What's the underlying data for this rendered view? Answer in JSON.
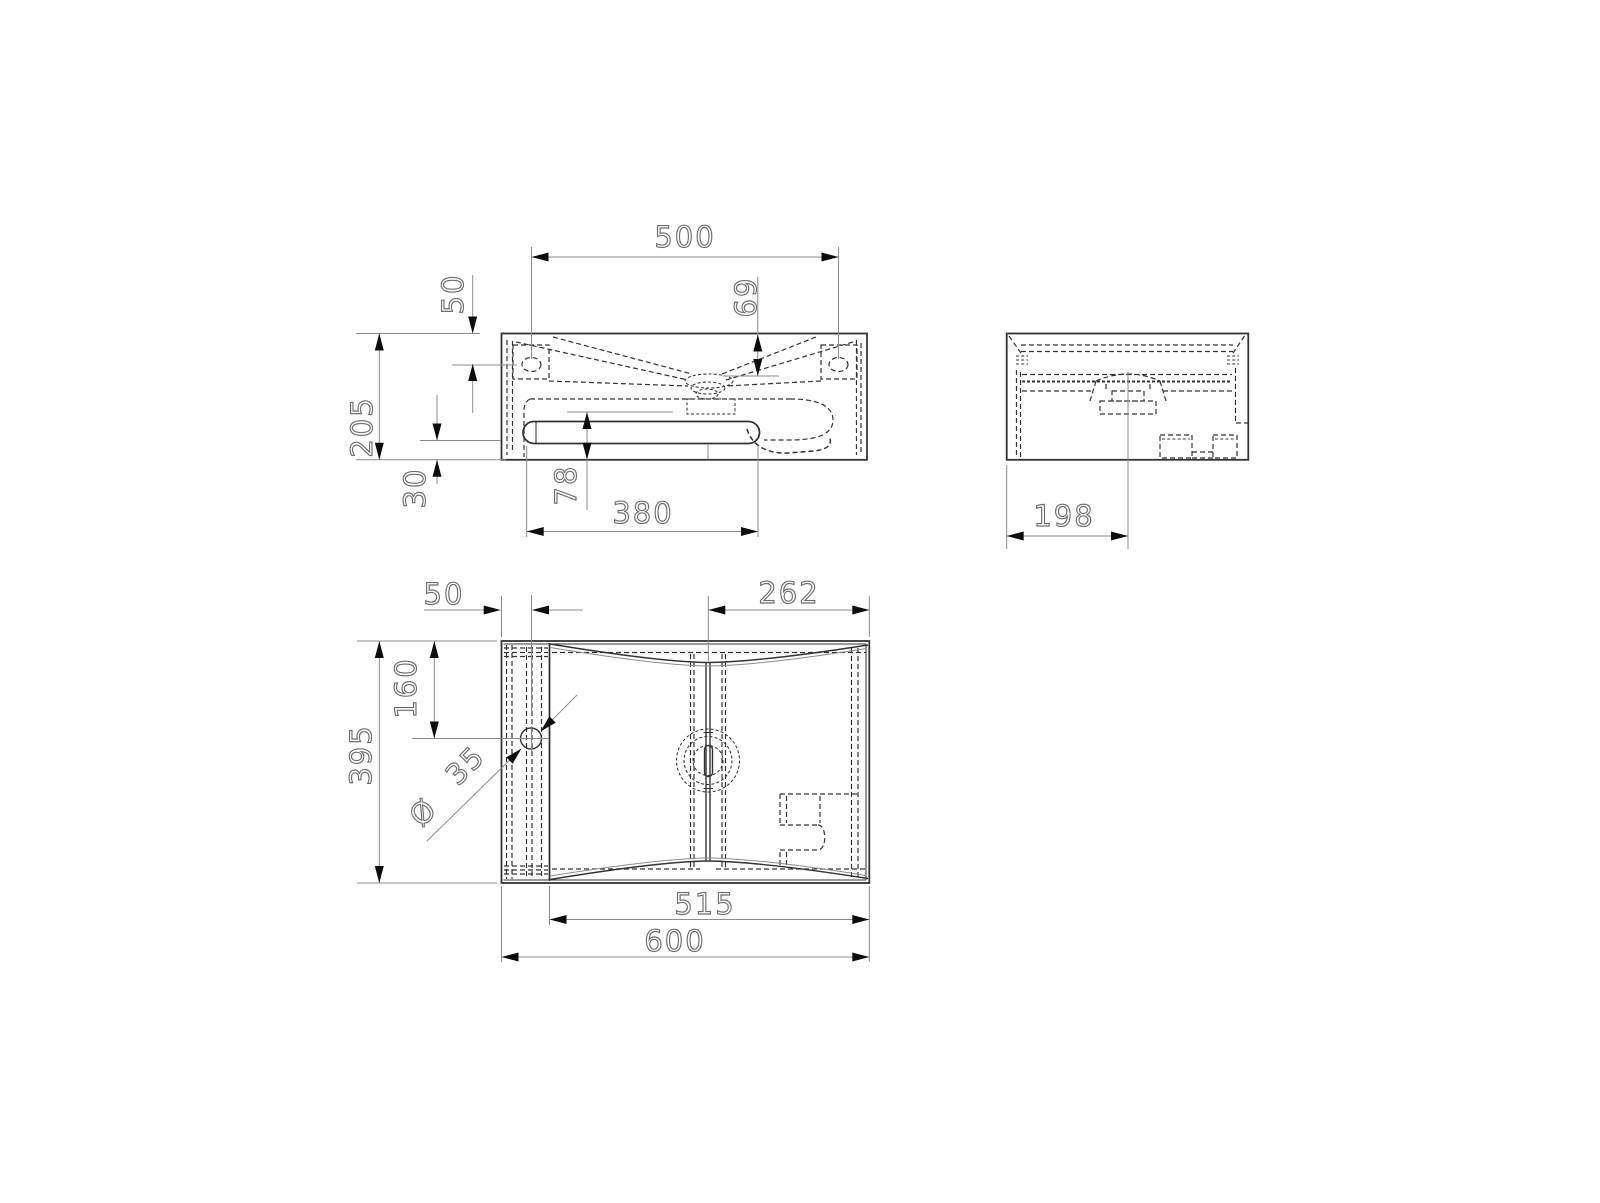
{
  "drawing": {
    "kind": "washbasin-dimension-drawing",
    "views": [
      "front",
      "side",
      "plan"
    ]
  },
  "colors": {
    "background": "#ffffff",
    "object_line": "#333333",
    "dim_line": "#8c8c8c",
    "text": "#6e6e6e",
    "arrow": "#0d0d0d"
  },
  "dims": {
    "front": {
      "holes_span": "500",
      "top_to_hole": "50",
      "height": "205",
      "top_to_drain": "69",
      "bottom_to_slot": "30",
      "slot_to_bottom": "78",
      "slot_width": "380"
    },
    "side": {
      "front_to_drain": "198"
    },
    "plan": {
      "edge_to_faucet": "50",
      "drain_to_edge": "262",
      "top_to_faucet": "160",
      "depth": "395",
      "dia_symbol": "Ø",
      "dia_value": "35",
      "bowl_width": "515",
      "width": "600"
    }
  }
}
